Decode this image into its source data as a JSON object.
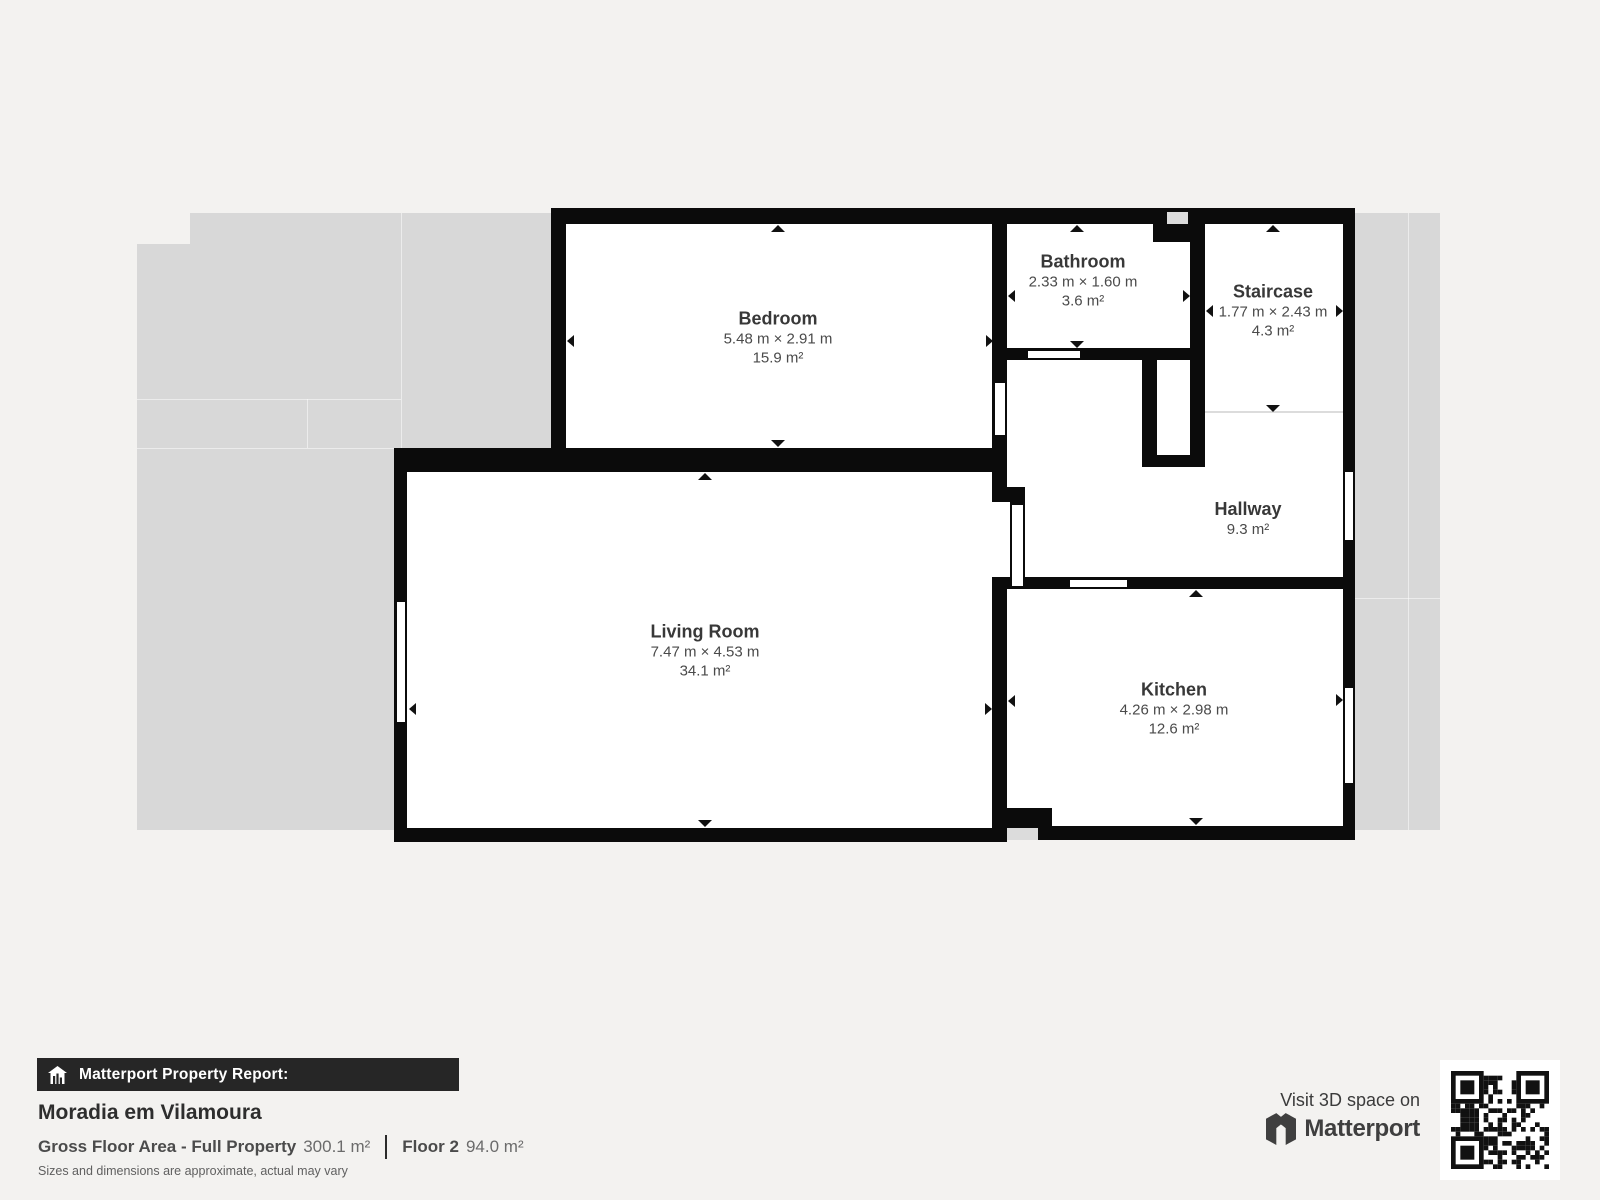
{
  "plan": {
    "rooms": {
      "bedroom": {
        "name": "Bedroom",
        "dims": "5.48 m × 2.91 m",
        "area": "15.9 m²"
      },
      "bathroom": {
        "name": "Bathroom",
        "dims": "2.33 m × 1.60 m",
        "area": "3.6 m²"
      },
      "staircase": {
        "name": "Staircase",
        "dims": "1.77 m × 2.43 m",
        "area": "4.3 m²"
      },
      "hallway": {
        "name": "Hallway",
        "area": "9.3 m²"
      },
      "living_room": {
        "name": "Living Room",
        "dims": "7.47 m × 4.53 m",
        "area": "34.1 m²"
      },
      "kitchen": {
        "name": "Kitchen",
        "dims": "4.26 m × 2.98 m",
        "area": "12.6 m²"
      }
    }
  },
  "footer": {
    "report_label": "Matterport Property Report:",
    "property_name": "Moradia em Vilamoura",
    "gross_label": "Gross Floor Area - Full Property",
    "gross_value": "300.1 m²",
    "floor_label": "Floor 2",
    "floor_value": "94.0 m²",
    "disclaimer": "Sizes and dimensions are approximate, actual may vary",
    "visit_text": "Visit 3D space on",
    "brand": "Matterport"
  },
  "colors": {
    "page_bg": "#f3f2f0",
    "backdrop_gray": "#d8d8d8",
    "wall_black": "#0b0b0b",
    "room_white": "#ffffff",
    "footer_bar": "#262626"
  }
}
